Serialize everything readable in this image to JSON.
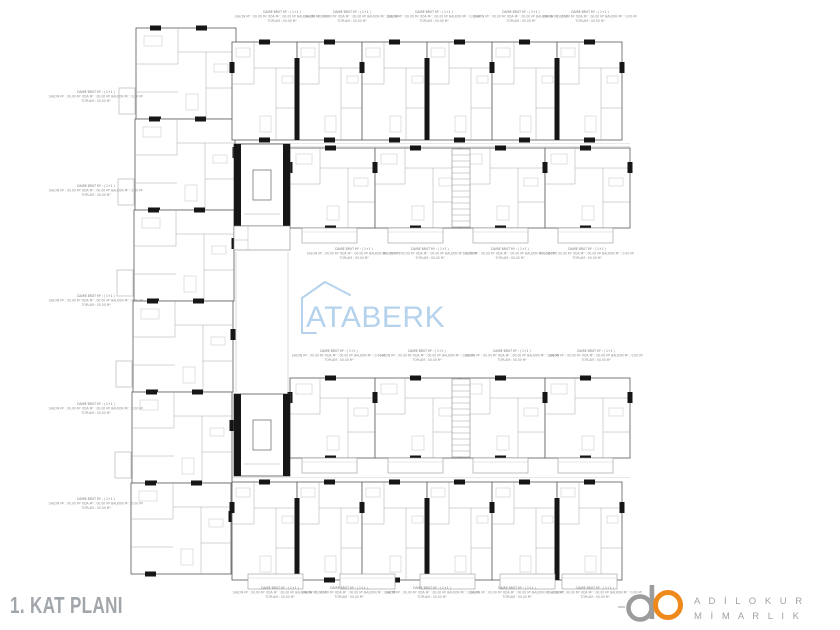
{
  "title": "1. KAT PLANI",
  "watermark": {
    "text": "ATABERK",
    "color": "#b5d3ec"
  },
  "logo": {
    "name_line1": "A D İ L O K U R",
    "name_line2": "M İ M A R L I K",
    "gray": "#9c9c9c",
    "orange": "#ee8a1c",
    "text_gray": "#a2a2a2"
  },
  "unit_label": {
    "l1": "DAİRE BRÜT M² : ( 1+1 )",
    "l2": "SALON M² : 00.00 M²   ODA M² : 00.00 M²   BALKON M² : 0.00 M²",
    "l3": "TOPLAM : 00.00 M²"
  },
  "plan": {
    "wall_color": "#6a6a6a",
    "interior_color": "#a8a8a8",
    "fixture_color": "#c4c4c4",
    "column_color": "#161616",
    "title_color": "#a1a6ab",
    "annotation_color": "#8d8d8d"
  }
}
